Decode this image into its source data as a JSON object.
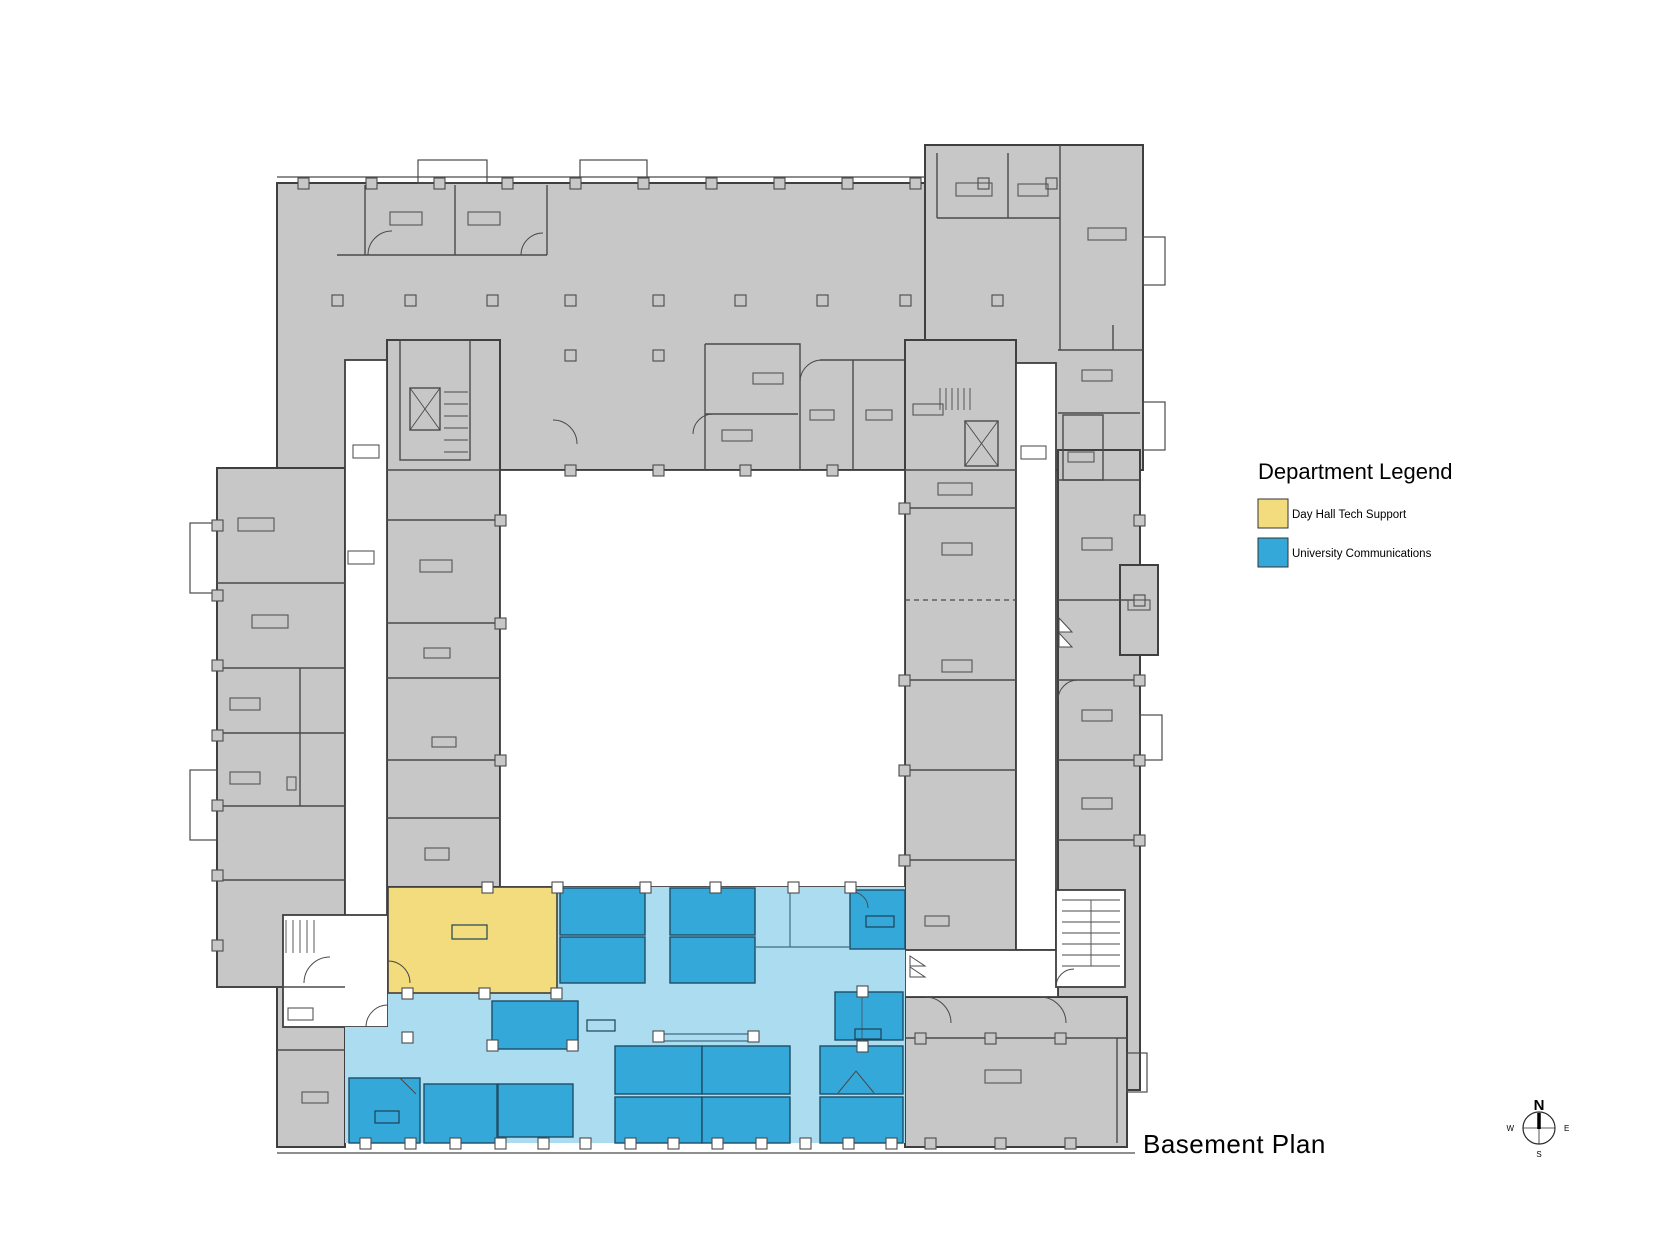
{
  "title": {
    "plan_label": "Basement Plan"
  },
  "legend": {
    "title": "Department Legend",
    "items": [
      {
        "label": "Day Hall Tech Support",
        "color": "#F2DC7E"
      },
      {
        "label": "University Communications",
        "color": "#35A8DA"
      }
    ]
  },
  "compass": {
    "n": "N",
    "e": "E",
    "s": "S",
    "w": "W"
  },
  "departments": [
    {
      "name": "Day Hall Tech Support",
      "fill": "#F2DC7E"
    },
    {
      "name": "University Communications",
      "fill": "#35A8DA"
    }
  ],
  "colors": {
    "wall": "#3f3f3f",
    "grayFill": "#c7c7c7",
    "grayStroke": "#4a4a4a",
    "yellow": "#F2DC7E",
    "blue": "#35A8DA",
    "blueStroke": "#1d4e66",
    "lightBlue": "#ABDCF0",
    "planText": "#333333"
  }
}
